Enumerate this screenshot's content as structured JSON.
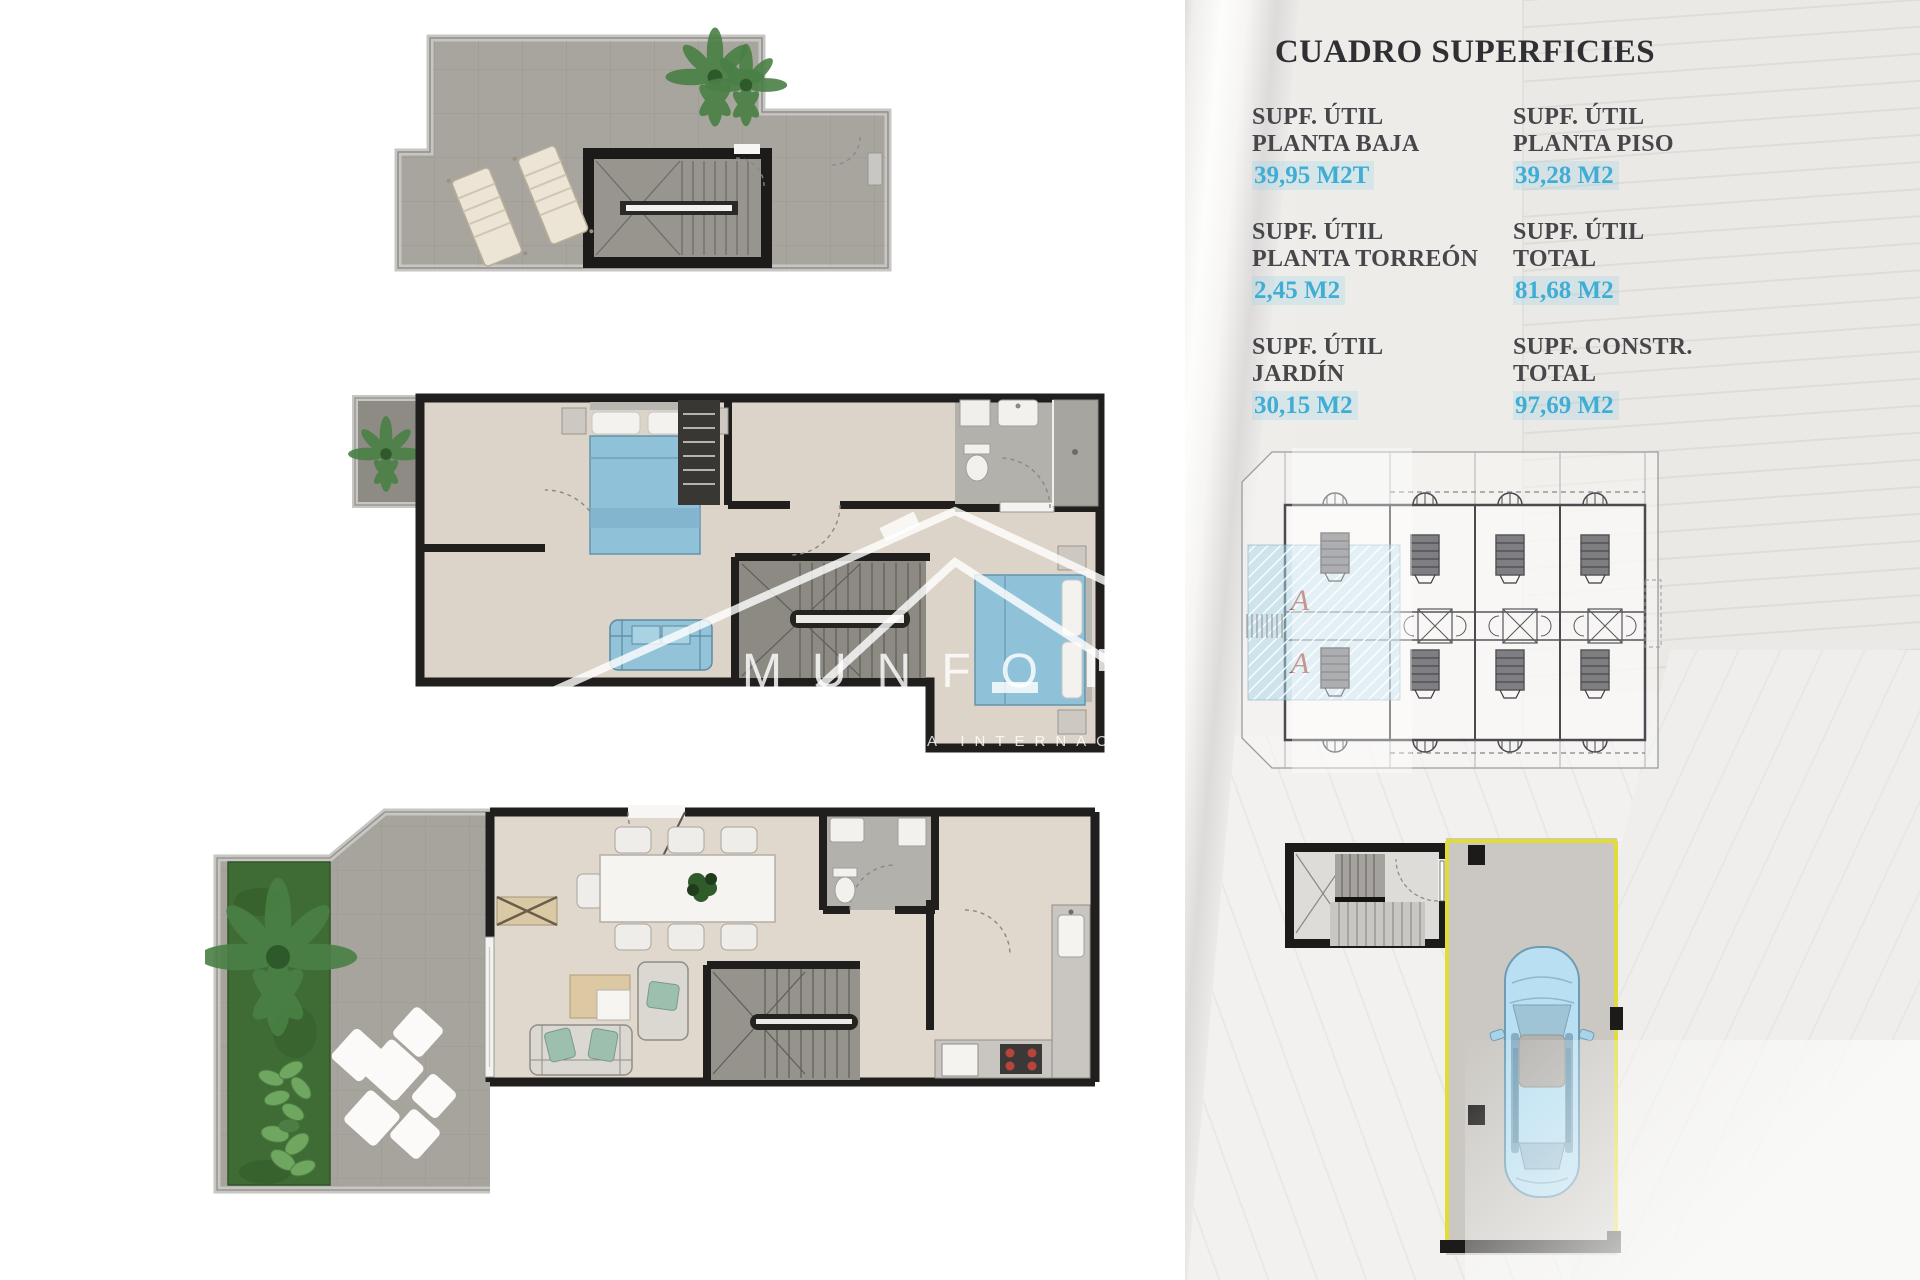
{
  "panel": {
    "title": "CUADRO SUPERFICIES",
    "entries": [
      {
        "lines": [
          "SUPF. ÚTIL",
          "PLANTA BAJA"
        ],
        "value": "39,95 M2T"
      },
      {
        "lines": [
          "SUPF. ÚTIL",
          "PLANTA PISO"
        ],
        "value": "39,28 M2"
      },
      {
        "lines": [
          "SUPF. ÚTIL",
          "PLANTA TORREÓN"
        ],
        "value": "2,45 M2"
      },
      {
        "lines": [
          "SUPF. ÚTIL",
          "TOTAL"
        ],
        "value": "81,68 M2"
      },
      {
        "lines": [
          "SUPF. ÚTIL",
          "JARDÍN"
        ],
        "value": "30,15 M2"
      },
      {
        "lines": [
          "SUPF. CONSTR.",
          "TOTAL"
        ],
        "value": "97,69 M2"
      }
    ]
  },
  "site_plan": {
    "unit_label": "A"
  },
  "watermark": {
    "brand": "MUNFO",
    "subtitle": "A INTERNAC"
  },
  "colors": {
    "value_blue": "#3FADD4",
    "title_dark": "#303034",
    "label_dark": "#47474B",
    "wall_black": "#1F1E1C",
    "floor_gray": "#A8A59E",
    "floor_beige": "#DED6CB",
    "bath_gray": "#B3B1AC",
    "garden_green": "#3F6C35",
    "furniture_blue": "#8FC2D9",
    "car_blue": "#B9E0F2",
    "parking_outline_yellow": "#E0DC3A",
    "unit_letter_red": "#A4554F",
    "site_hatch_blue": "#A8D6E8"
  }
}
